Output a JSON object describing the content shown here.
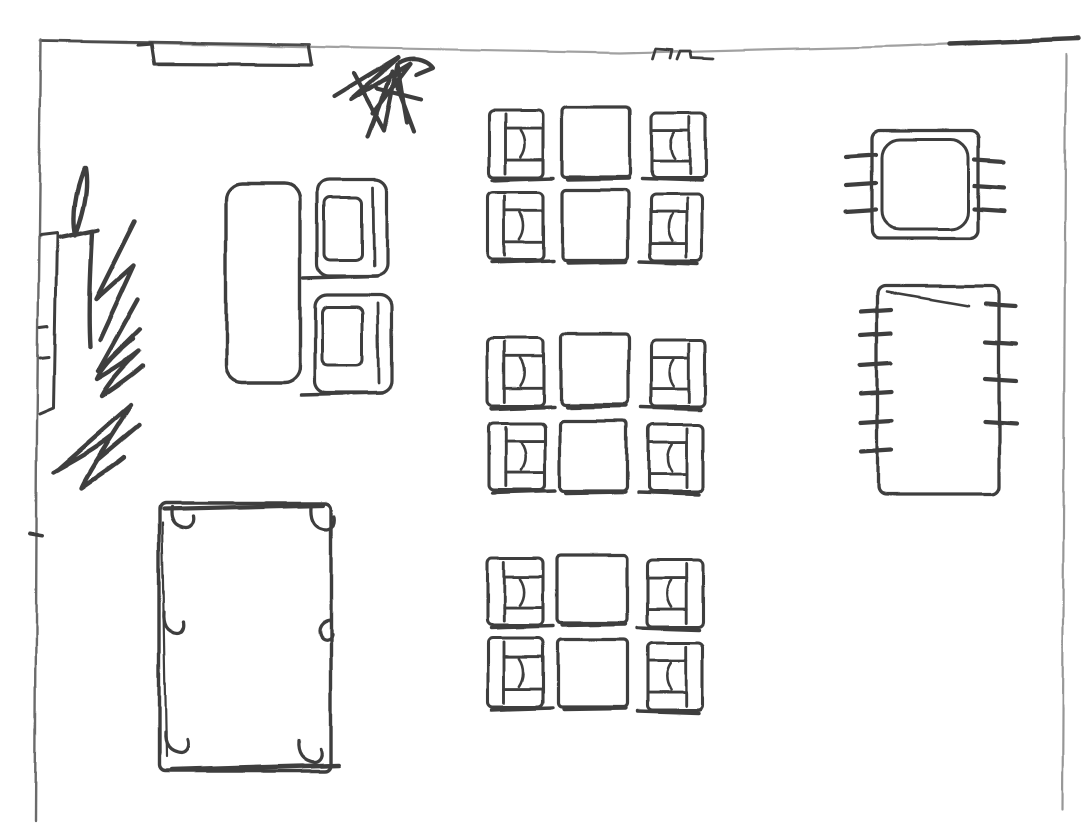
{
  "canvas": {
    "width": 1090,
    "height": 823,
    "background": "#ffffff",
    "ink": "#2f2f2f",
    "wall_gray": "#9a9a9a",
    "wall_dark": "#5f5f5f"
  },
  "elements": [
    {
      "name": "top-wall",
      "type": "polyline",
      "points": [
        [
          40,
          41
        ],
        [
          340,
          48
        ],
        [
          620,
          53
        ],
        [
          900,
          46
        ],
        [
          1063,
          39
        ]
      ],
      "color": "#9a9a9a",
      "sw": 2.2
    },
    {
      "name": "top-wall-ink-left",
      "type": "polyline",
      "points": [
        [
          42,
          41
        ],
        [
          310,
          45
        ]
      ],
      "color": "#3c3c3c",
      "sw": 2.8
    },
    {
      "name": "top-wall-ink-right",
      "type": "polyline",
      "points": [
        [
          950,
          44
        ],
        [
          1078,
          39
        ]
      ],
      "color": "#2f2f2f",
      "sw": 4.4
    },
    {
      "name": "left-wall",
      "type": "polyline",
      "points": [
        [
          41,
          40
        ],
        [
          37,
          430
        ],
        [
          35,
          822
        ]
      ],
      "color": "#5f5f5f",
      "sw": 2.4
    },
    {
      "name": "right-wall",
      "type": "polyline",
      "points": [
        [
          1066,
          55
        ],
        [
          1062,
          810
        ]
      ],
      "color": "#8f8f8f",
      "sw": 2.2
    },
    {
      "name": "left-wall-tick",
      "type": "path",
      "d": "M30,534 L42,536",
      "sw": 4
    },
    {
      "name": "entry-recess",
      "type": "path",
      "d": "M138,45 L151,44 L154,64 L312,65 L309,47",
      "sw": 3.2
    },
    {
      "name": "door-marks",
      "type": "path",
      "d": "M652,59 L655,49 L672,50 L670,58 M677,59 L680,51 L690,51 L691,57 L712,58",
      "sw": 2.8
    },
    {
      "name": "plant-scribble-top",
      "type": "path",
      "sw": 4.2,
      "d": "M334,97 L398,58 L351,100 L410,64 L373,113 M354,74 L384,130 L397,65 L407,122 M368,137 L392,72 L414,131 M399,63 C411,56 426,59 433,68 L416,75 M377,88 L421,99"
    },
    {
      "name": "plant-scribble-left",
      "type": "path",
      "sw": 4.4,
      "d": "M84,168 C75,190 71,215 75,236 C82,214 89,190 85,168 M60,238 L98,230 M92,232 C90,272 88,312 90,347 M135,222 L96,300 L134,266 L100,340 M138,300 L98,372 L140,330 M133,340 C116,354 102,368 97,380 C114,370 129,360 139,352 C122,369 108,385 102,397 C119,386 134,375 143,367 M58,470 L132,405 L96,462 L140,425 M54,472 C72,462 94,450 112,436 C100,458 88,474 82,488 C96,478 112,468 124,458"
    },
    {
      "name": "wall-shelf",
      "type": "path",
      "d": "M40,236 L57,234 L54,408 L40,414 M40,327 L48,326 M40,357 L49,356",
      "sw": 3
    },
    {
      "name": "sofa",
      "type": "rect",
      "x": 226,
      "y": 184,
      "w": 74,
      "h": 198,
      "rx": 16,
      "sw": 3.4
    },
    {
      "name": "armchair-top",
      "type": "armchair",
      "x": 317,
      "y": 180,
      "w": 70,
      "h": 96,
      "inner": [
        324,
        198,
        38,
        62
      ]
    },
    {
      "name": "armchair-bottom",
      "type": "armchair",
      "x": 315,
      "y": 295,
      "w": 77,
      "h": 98,
      "inner": [
        322,
        307,
        41,
        58
      ]
    },
    {
      "name": "dining-chair-left-1-1",
      "type": "chair",
      "facing": "right",
      "x": 488,
      "y": 110,
      "w": 55,
      "h": 67
    },
    {
      "name": "dining-table-1-1",
      "type": "table",
      "x": 562,
      "y": 107,
      "w": 68,
      "h": 70
    },
    {
      "name": "dining-chair-right-1-1",
      "type": "chair",
      "facing": "left",
      "x": 652,
      "y": 113,
      "w": 54,
      "h": 65
    },
    {
      "name": "dining-chair-left-1-2",
      "type": "chair",
      "facing": "right",
      "x": 488,
      "y": 192,
      "w": 55,
      "h": 68
    },
    {
      "name": "dining-table-1-2",
      "type": "table",
      "x": 562,
      "y": 190,
      "w": 66,
      "h": 70
    },
    {
      "name": "dining-chair-right-1-2",
      "type": "chair",
      "facing": "left",
      "x": 650,
      "y": 195,
      "w": 52,
      "h": 65
    },
    {
      "name": "dining-chair-left-2-1",
      "type": "chair",
      "facing": "right",
      "x": 488,
      "y": 338,
      "w": 56,
      "h": 68
    },
    {
      "name": "dining-table-2-1",
      "type": "table",
      "x": 561,
      "y": 334,
      "w": 67,
      "h": 71
    },
    {
      "name": "dining-chair-right-2-1",
      "type": "chair",
      "facing": "left",
      "x": 651,
      "y": 340,
      "w": 54,
      "h": 67
    },
    {
      "name": "dining-chair-left-2-2",
      "type": "chair",
      "facing": "right",
      "x": 489,
      "y": 423,
      "w": 56,
      "h": 67
    },
    {
      "name": "dining-table-2-2",
      "type": "table",
      "x": 560,
      "y": 421,
      "w": 67,
      "h": 70
    },
    {
      "name": "dining-chair-right-2-2",
      "type": "chair",
      "facing": "left",
      "x": 648,
      "y": 425,
      "w": 55,
      "h": 67
    },
    {
      "name": "dining-chair-left-3-1",
      "type": "chair",
      "facing": "right",
      "x": 487,
      "y": 558,
      "w": 56,
      "h": 67
    },
    {
      "name": "dining-table-3-1",
      "type": "table",
      "x": 557,
      "y": 555,
      "w": 70,
      "h": 68
    },
    {
      "name": "dining-chair-right-3-1",
      "type": "chair",
      "facing": "left",
      "x": 647,
      "y": 560,
      "w": 56,
      "h": 67
    },
    {
      "name": "dining-chair-left-3-2",
      "type": "chair",
      "facing": "right",
      "x": 488,
      "y": 638,
      "w": 55,
      "h": 69
    },
    {
      "name": "dining-table-3-2",
      "type": "table",
      "x": 558,
      "y": 640,
      "w": 69,
      "h": 67
    },
    {
      "name": "dining-chair-right-3-2",
      "type": "chair",
      "facing": "left",
      "x": 647,
      "y": 643,
      "w": 56,
      "h": 67
    },
    {
      "name": "pool-table",
      "type": "pool",
      "x": 159,
      "y": 503,
      "w": 172,
      "h": 268,
      "pockets": [
        "M171,507 C169,519 173,527 185,528 C191,528 193,522 192,516",
        "M311,507 C310,520 315,529 327,529 C333,528 335,522 334,516",
        "M164,612 C163,624 167,632 177,633 C182,633 184,628 183,622",
        "M330,620 C322,621 317,628 321,636 C324,641 331,640 332,634",
        "M165,733 C164,745 169,753 181,754 C187,753 189,747 187,741",
        "M299,741 C298,753 303,761 315,762 C321,761 323,755 321,749"
      ]
    },
    {
      "name": "side-table-right",
      "type": "ticked",
      "x": 872,
      "y": 131,
      "w": 106,
      "h": 107,
      "inner": true,
      "lt": [
        156,
        184,
        211
      ],
      "rt": [
        161,
        187,
        210
      ],
      "out": 26,
      "inn": 4
    },
    {
      "name": "long-table-right",
      "type": "ticked",
      "x": 878,
      "y": 286,
      "w": 121,
      "h": 208,
      "inner": false,
      "lt": [
        311,
        334,
        364,
        392,
        421,
        450
      ],
      "rt": [
        305,
        342,
        380,
        424
      ],
      "out": 17,
      "inn": 14,
      "overdraw": "M887,292 L968,306"
    }
  ]
}
